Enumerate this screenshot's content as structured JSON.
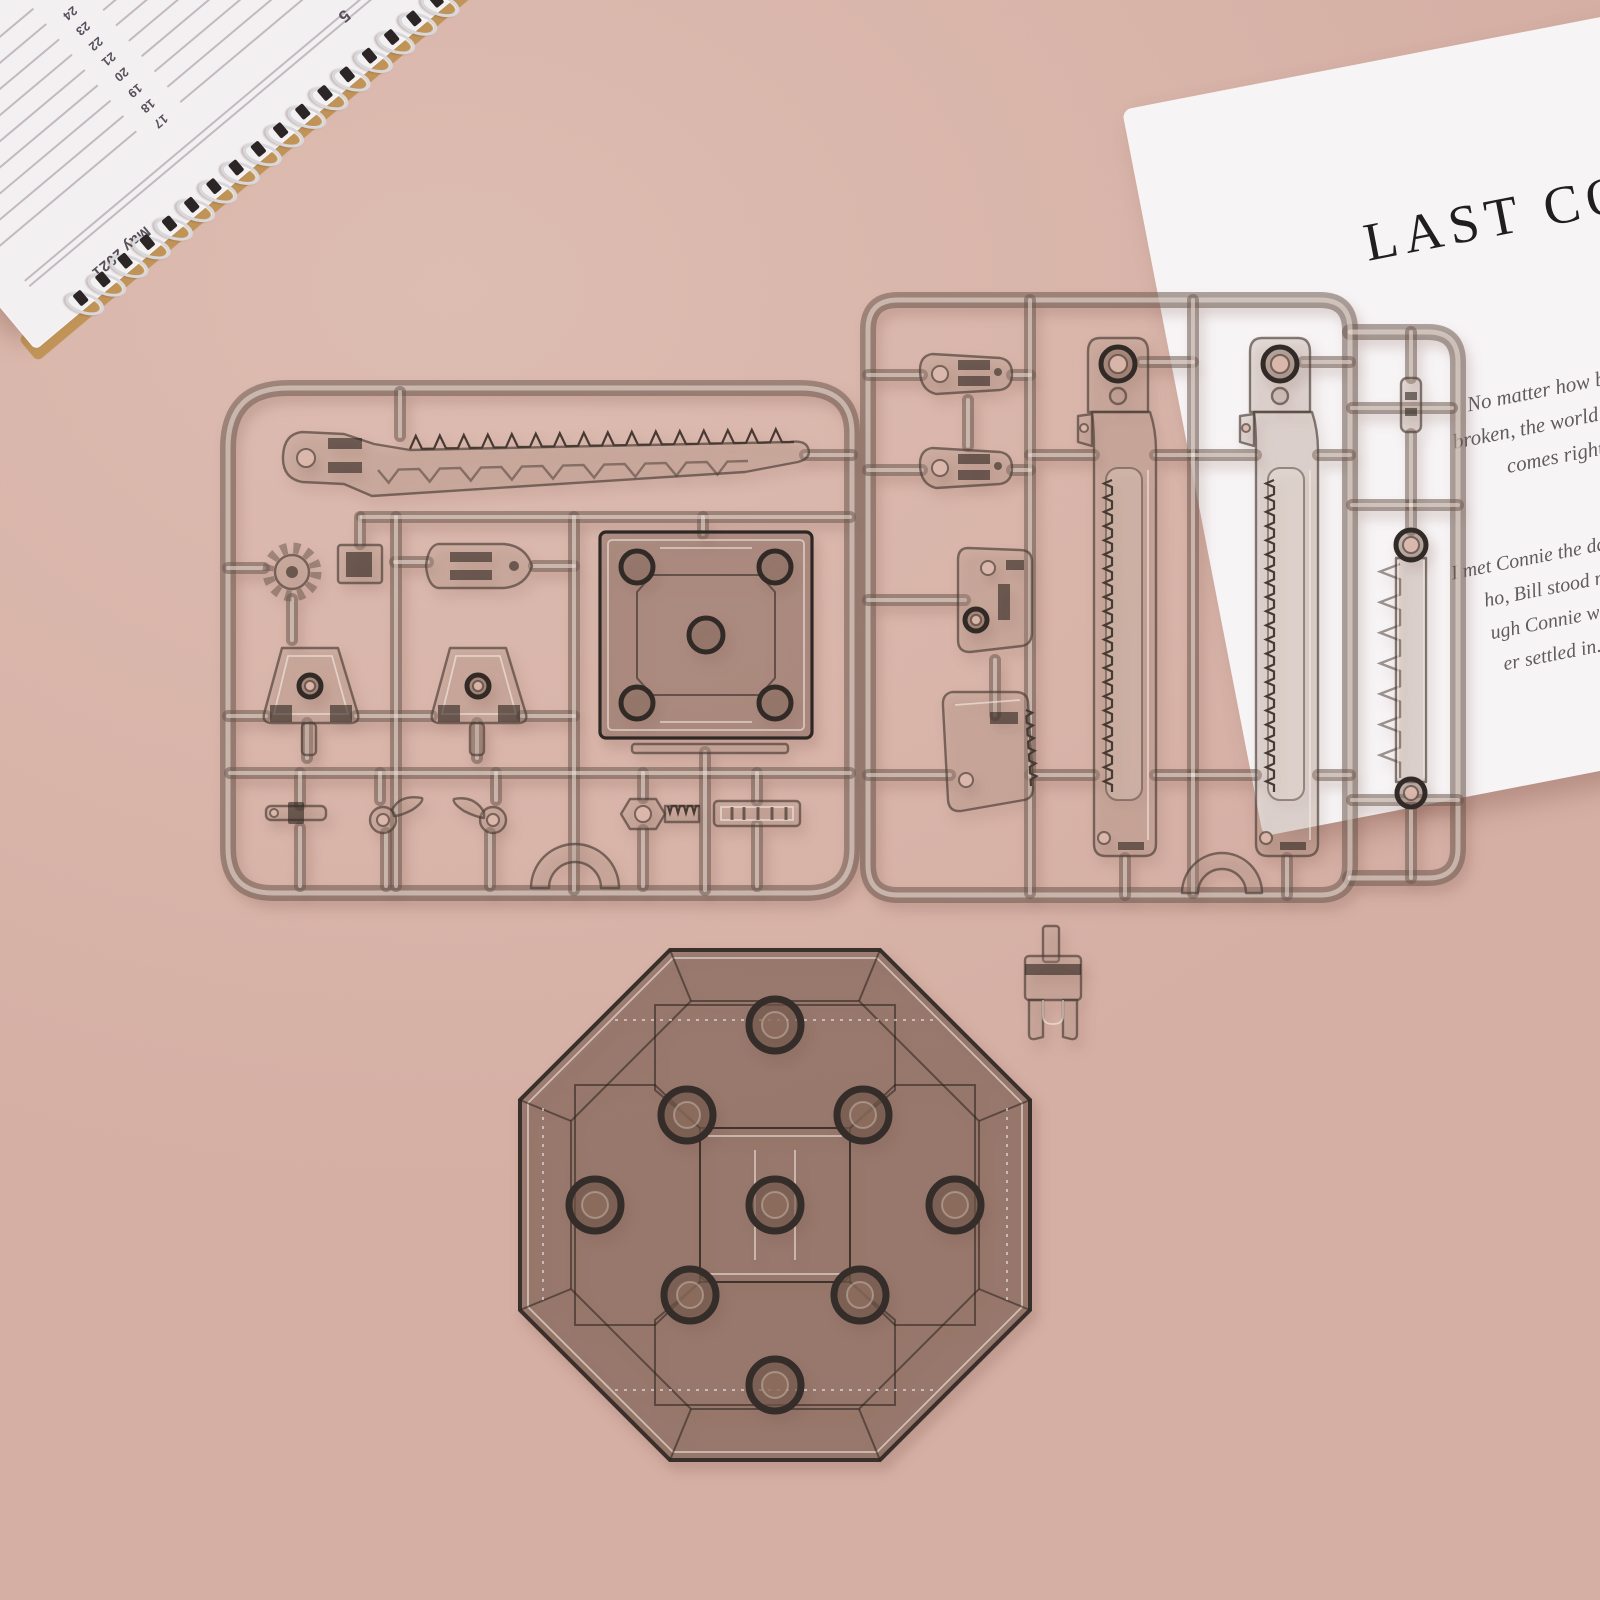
{
  "colors": {
    "background": "#d5afa4",
    "background_light": "#ddbcb1",
    "paper_white": "#f7f4f5",
    "notebook_white": "#f3f0f2",
    "notebook_backing": "#c29559",
    "coil_silver": "#d8d7db",
    "ruled_line": "#b6abb4",
    "date_ink": "#56505b",
    "title_ink": "#211e1f",
    "script_ink": "#605b5d",
    "plastic_smoke": "rgba(106,87,77,0.52)",
    "plastic_highlight": "rgba(240,228,219,0.55)",
    "plastic_highlight2": "rgba(245,236,228,0.6)",
    "plastic_fill": "rgba(176,150,137,0.27)",
    "plastic_stroke": "rgba(72,59,51,0.65)",
    "plastic_dark": "rgba(45,37,32,0.6)",
    "base_fill": "rgba(108,82,70,0.5)",
    "base_edge": "#3a302b"
  },
  "notebook": {
    "month_label": "May 2021",
    "partial_number": "5",
    "dates": [
      "17",
      "18",
      "19",
      "20",
      "21",
      "22",
      "23",
      "24"
    ]
  },
  "paper": {
    "title": "LAST CONFE",
    "paragraph1": [
      "No matter how bad your heart",
      "broken, the world doesn't stop for y",
      "comes right back up the"
    ],
    "paragraph2": [
      "I met Connie the day she was admitted to th",
      "ho, Bill stood nervously nearby as sh",
      "ugh Connie was in the final stages of",
      "er settled in. I finished marking her"
    ]
  },
  "objects": {
    "notebook": "spiral-planner",
    "paper": "printed-story-page",
    "sprue_a": "model-kit-runner-a",
    "sprue_b": "model-kit-runner-b",
    "display_base": "octagonal-display-base",
    "clip": "support-clip-part"
  }
}
